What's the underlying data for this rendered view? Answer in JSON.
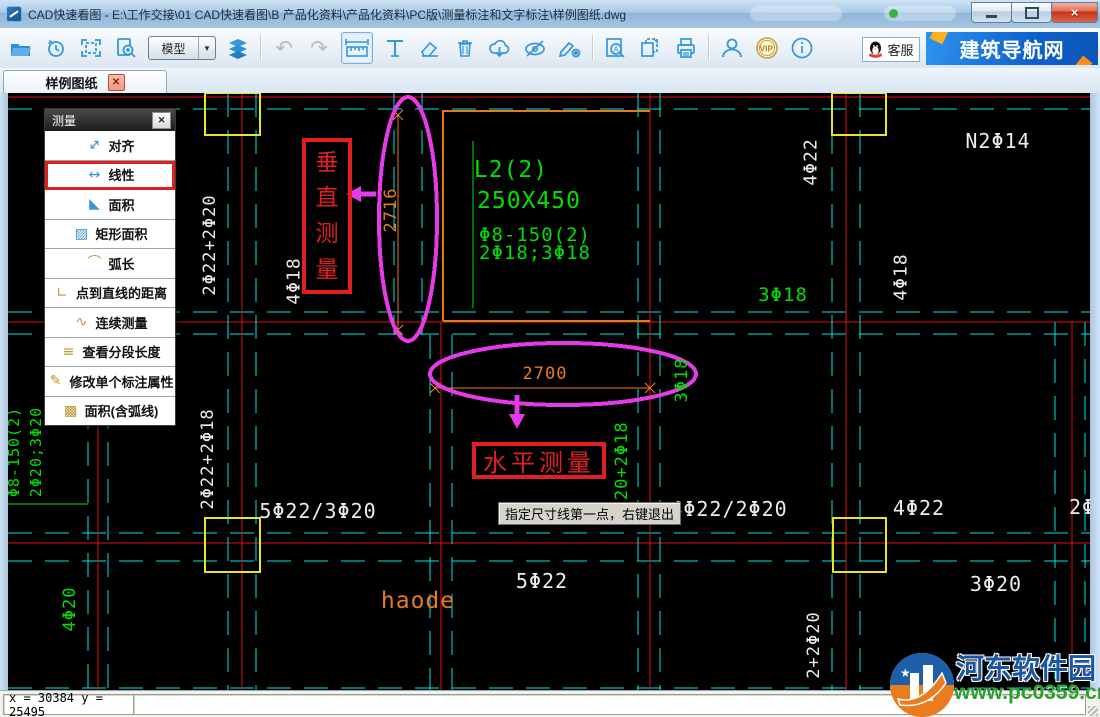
{
  "window": {
    "title": "CAD快速看图 - E:\\工作交接\\01 CAD快速看图\\B 产品化资料\\产品化资料\\PC版\\测量标注和文字标注\\样例图纸.dwg"
  },
  "toolbar": {
    "model_selector": "模型",
    "kefu_label": "客服",
    "banner_label": "建筑导航网",
    "vip_label": "VIP",
    "icon_names": [
      "open-file-icon",
      "history-icon",
      "fit-extents-icon",
      "page-zoom-icon",
      "layers-icon",
      "undo-icon",
      "redo-icon",
      "measure-icon",
      "text-annotate-icon",
      "eraser-icon",
      "delete-icon",
      "cloud-download-icon",
      "hide-layer-icon",
      "annotation-settings-icon",
      "find-text-icon",
      "copy-page-icon",
      "print-icon",
      "user-icon",
      "vip-icon",
      "about-icon"
    ]
  },
  "tabbar": {
    "active_tab": "样例图纸"
  },
  "measure_panel": {
    "title": "测量",
    "items": [
      {
        "label": "对齐",
        "icon": "align-dim-icon",
        "color": "blue"
      },
      {
        "label": "线性",
        "icon": "linear-dim-icon",
        "color": "blue",
        "active": true
      },
      {
        "label": "面积",
        "icon": "area-icon",
        "color": "blue"
      },
      {
        "label": "矩形面积",
        "icon": "rect-area-icon",
        "color": "blue"
      },
      {
        "label": "弧长",
        "icon": "arc-length-icon",
        "color": "gold"
      },
      {
        "label": "点到直线的距离",
        "icon": "point-to-line-icon",
        "color": "gold"
      },
      {
        "label": "连续测量",
        "icon": "continuous-measure-icon",
        "color": "gold"
      },
      {
        "label": "查看分段长度",
        "icon": "segment-length-icon",
        "color": "gold"
      },
      {
        "label": "修改单个标注属性",
        "icon": "edit-dim-attr-icon",
        "color": "gold"
      },
      {
        "label": "面积(含弧线)",
        "icon": "area-arc-icon",
        "color": "gold"
      }
    ]
  },
  "canvas": {
    "vertical_callout": "垂直测量",
    "horizontal_callout": "水平测量",
    "tooltip": "指定尺寸线第一点，右键退出",
    "dimensions": {
      "vertical": "2716",
      "horizontal": "2700"
    },
    "colors": {
      "grid_cyan": "#00e5e5",
      "axis_red": "#e01010",
      "rebar_green": "#00e000",
      "column_yellow": "#e8e820",
      "dim_orange": "#e87a1e",
      "highlight_magenta": "#e53ae5",
      "callout_red": "#e02020"
    },
    "labels": [
      {
        "text": "L2(2)",
        "x": 503,
        "y": 77,
        "color": "green",
        "size": 23
      },
      {
        "text": "250X450",
        "x": 521,
        "y": 108,
        "color": "green",
        "size": 23
      },
      {
        "text": "Φ8-150(2)",
        "x": 527,
        "y": 142,
        "color": "green",
        "size": 19
      },
      {
        "text": "2Φ18;3Φ18",
        "x": 527,
        "y": 160,
        "color": "green",
        "size": 19
      },
      {
        "text": "2716",
        "x": 383,
        "y": 117,
        "color": "orange",
        "size": 17,
        "rot": true
      },
      {
        "text": "2700",
        "x": 537,
        "y": 281,
        "color": "orange",
        "size": 17
      },
      {
        "text": "N2Φ14",
        "x": 990,
        "y": 48,
        "color": "white",
        "size": 20
      },
      {
        "text": "4Φ22",
        "x": 803,
        "y": 69,
        "color": "white",
        "size": 18,
        "rot": true
      },
      {
        "text": "4Φ18",
        "x": 893,
        "y": 184,
        "color": "white",
        "size": 18,
        "rot": true
      },
      {
        "text": "4Φ18",
        "x": 286,
        "y": 188,
        "color": "white",
        "size": 18,
        "rot": true
      },
      {
        "text": "2Φ22+2Φ20",
        "x": 202,
        "y": 152,
        "color": "white",
        "size": 17,
        "rot": true
      },
      {
        "text": "2Φ22+2Φ18",
        "x": 200,
        "y": 366,
        "color": "white",
        "size": 17,
        "rot": true
      },
      {
        "text": "2Φ20+2Φ18",
        "x": 614,
        "y": 379,
        "color": "green",
        "size": 17,
        "rot": true
      },
      {
        "text": "3Φ18",
        "x": 674,
        "y": 287,
        "color": "green",
        "size": 17,
        "rot": true
      },
      {
        "text": "3Φ18",
        "x": 775,
        "y": 202,
        "color": "green",
        "size": 19
      },
      {
        "text": "5Φ22/3Φ20",
        "x": 310,
        "y": 418,
        "color": "white",
        "size": 20
      },
      {
        "text": "4Φ22/2Φ20",
        "x": 721,
        "y": 416,
        "color": "white",
        "size": 20
      },
      {
        "text": "4Φ22",
        "x": 911,
        "y": 415,
        "color": "white",
        "size": 20
      },
      {
        "text": "2Φ",
        "x": 1074,
        "y": 414,
        "color": "white",
        "size": 20
      },
      {
        "text": "5Φ22",
        "x": 534,
        "y": 488,
        "color": "white",
        "size": 20
      },
      {
        "text": "3Φ20",
        "x": 988,
        "y": 491,
        "color": "white",
        "size": 20
      },
      {
        "text": "haode",
        "x": 410,
        "y": 508,
        "color": "orange",
        "size": 23
      },
      {
        "text": "4Φ20",
        "x": 62,
        "y": 516,
        "color": "green",
        "size": 17,
        "rot": true
      },
      {
        "text": "2+2Φ20",
        "x": 806,
        "y": 552,
        "color": "white",
        "size": 17,
        "rot": true
      },
      {
        "text": "Φ8-150(2)",
        "x": 6,
        "y": 359,
        "color": "green",
        "size": 15,
        "rot": true
      },
      {
        "text": "2Φ20;3Φ20",
        "x": 28,
        "y": 359,
        "color": "green",
        "size": 15,
        "rot": true
      }
    ]
  },
  "status_bar": {
    "coordinates": "x = 30384  y = 25495"
  },
  "watermark": {
    "site_name": "河东软件园",
    "site_url": "www.pc0359.cn"
  }
}
